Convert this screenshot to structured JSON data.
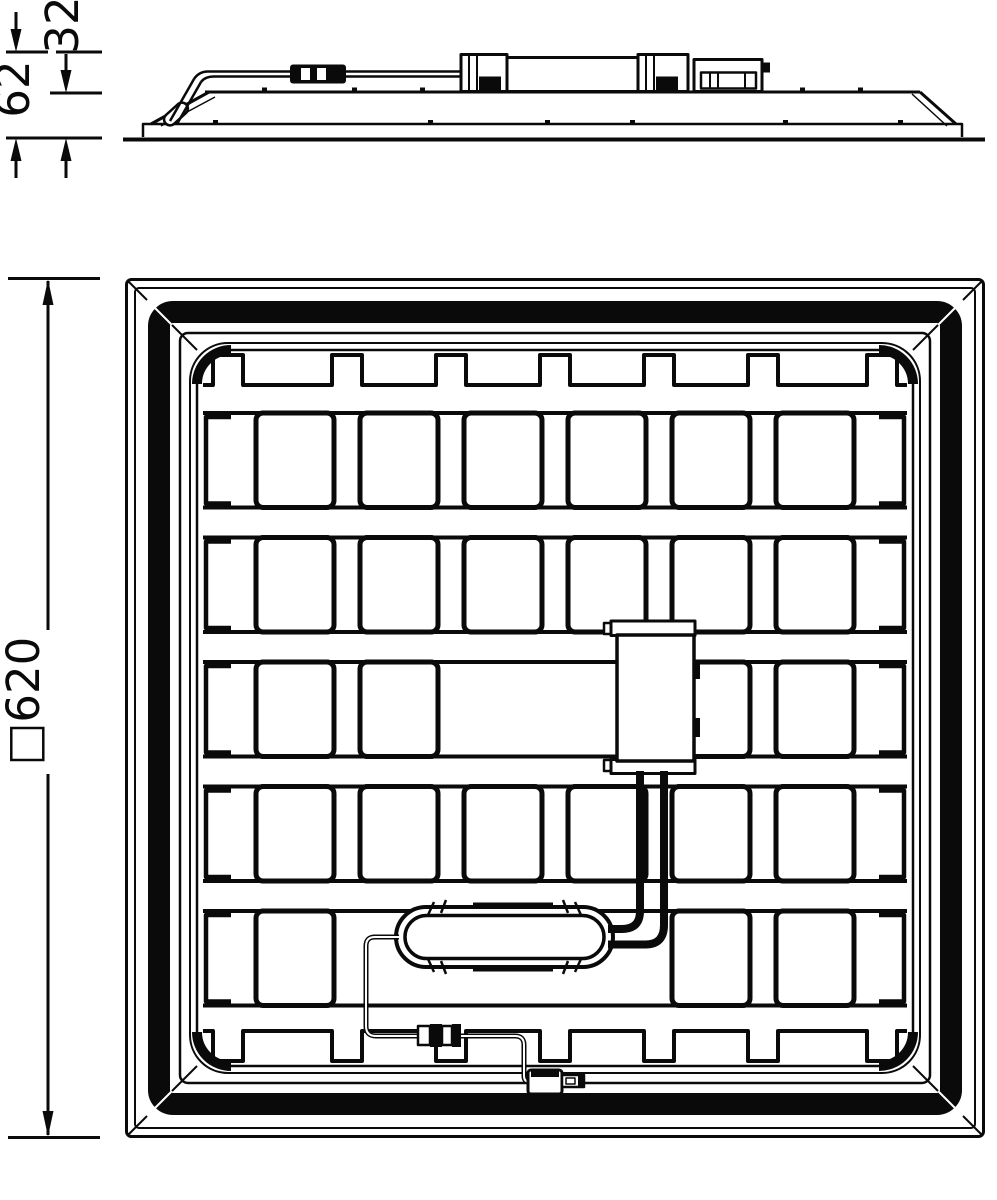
{
  "dimensions": {
    "side_total_height": "62",
    "side_recess_depth": "32",
    "rear_outer_size": "□620"
  },
  "rear_grid": {
    "rows": 5,
    "cols": 6,
    "missing_cells": [
      [
        2,
        2
      ],
      [
        2,
        3
      ],
      [
        4,
        1
      ],
      [
        4,
        2
      ],
      [
        4,
        3
      ]
    ]
  },
  "colors": {
    "line": "#0a0a0a",
    "background": "#ffffff"
  }
}
